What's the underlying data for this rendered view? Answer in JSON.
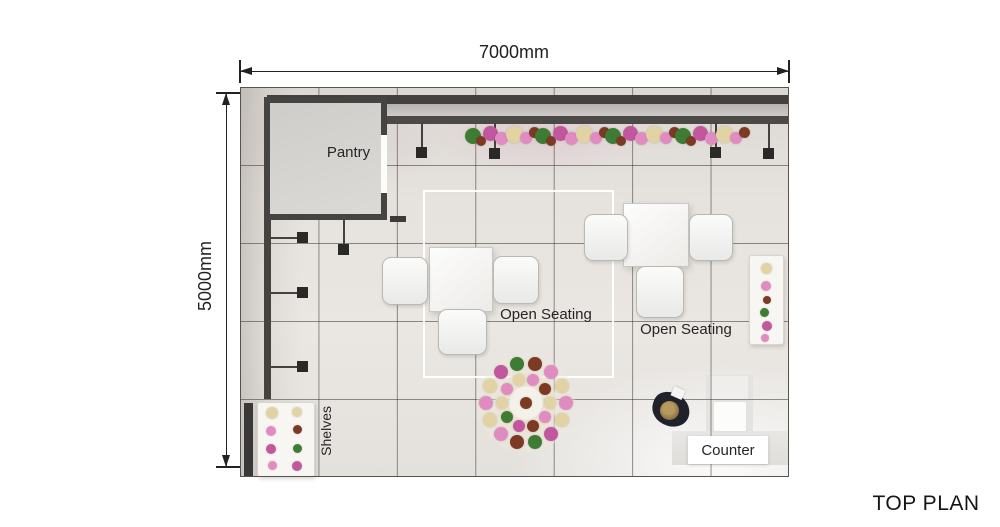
{
  "title": "TOP PLAN",
  "dimensions": {
    "width": "7000mm",
    "height": "5000mm"
  },
  "grid": {
    "columns": 7,
    "rows": 5
  },
  "labels": {
    "pantry": "Pantry",
    "open_seating_a": "Open Seating",
    "open_seating_b": "Open Seating",
    "shelves": "Shelves",
    "counter": "Counter"
  },
  "palette": {
    "wall_dark": "#454340",
    "floor_light": "#e8e5e1",
    "flower_pink": "#e08cc0",
    "flower_magenta": "#c2579e",
    "flower_beige": "#e2d3a4",
    "flower_green": "#3f7c33",
    "flower_maroon": "#7c3a24",
    "wreath_center": "#f2efe8"
  }
}
